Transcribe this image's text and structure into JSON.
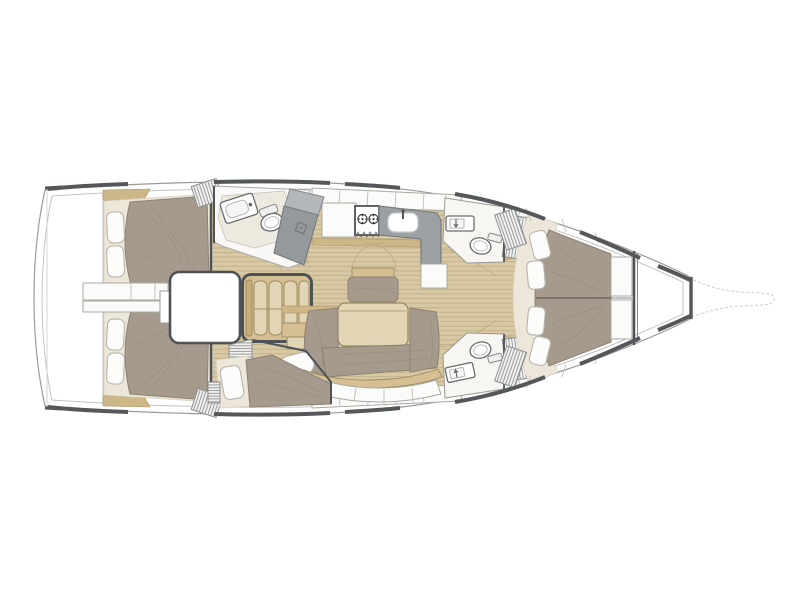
{
  "diagram": {
    "type": "sailboat-interior-floor-plan",
    "view": "top-down",
    "bow_direction": "right",
    "areas": [
      {
        "name": "aft-cabin-port",
        "furniture": [
          "double-berth",
          "pillows",
          "louvered-locker"
        ]
      },
      {
        "name": "aft-cabin-starboard",
        "furniture": [
          "double-berth",
          "pillows",
          "louvered-locker"
        ]
      },
      {
        "name": "aft-passage",
        "furniture": [
          "engine-box",
          "storage-panels"
        ]
      },
      {
        "name": "companionway",
        "furniture": [
          "ladder-4-steps"
        ]
      },
      {
        "name": "aft-head-port",
        "furniture": [
          "sink",
          "toilet",
          "shower"
        ]
      },
      {
        "name": "galley",
        "furniture": [
          "two-burner-stove",
          "sink",
          "l-shaped-counter",
          "lockers"
        ]
      },
      {
        "name": "salon",
        "furniture": [
          "dining-table",
          "u-settee",
          "centerline-bench",
          "nav-seat",
          "lockers"
        ]
      },
      {
        "name": "midship-berth-starboard",
        "furniture": [
          "single-berth",
          "pillow",
          "louvered-panel"
        ]
      },
      {
        "name": "forward-head-port",
        "furniture": [
          "sink",
          "toilet",
          "grate"
        ]
      },
      {
        "name": "forward-head-starboard",
        "furniture": [
          "sink",
          "toilet",
          "grate"
        ]
      },
      {
        "name": "forward-cabin",
        "furniture": [
          "island-double-berth",
          "four-pillows",
          "side-steps",
          "louvered-lockers"
        ]
      },
      {
        "name": "bow-sail-locker",
        "furniture": []
      },
      {
        "name": "bowsprit",
        "furniture": []
      }
    ]
  },
  "colors": {
    "bg": "#ffffff",
    "hullLine": "#9a9a9a",
    "hullThick": "#55585a",
    "deckLine": "#c4c4c4",
    "ghost": "#cccccc",
    "teak": "#d8c9a4",
    "teakStripe": "#c2b28c",
    "trim": "#cdb787",
    "wood": "#d6c093",
    "woodLight": "#e2d5b5",
    "woodDark": "#9b8a60",
    "cushion": "#a69a8d",
    "cushionEdge": "#8d8173",
    "cream": "#ede7da",
    "creamEdge": "#d5cfc0",
    "pillow": "#fcfcfb",
    "pillowEdge": "#b8b4ac",
    "white": "#fbfbfa",
    "whiteEdge": "#a9a9a4",
    "ivory": "#eceade",
    "counter": "#9ba0a3",
    "counterDark": "#94999c",
    "counterLight": "#b3b7b9",
    "counterEdge": "#75797c",
    "wall": "#4e5254",
    "hatchLine": "#8b8f92",
    "fixtureEdge": "#6b6b6b",
    "arcLine": "#c2ab7e"
  }
}
